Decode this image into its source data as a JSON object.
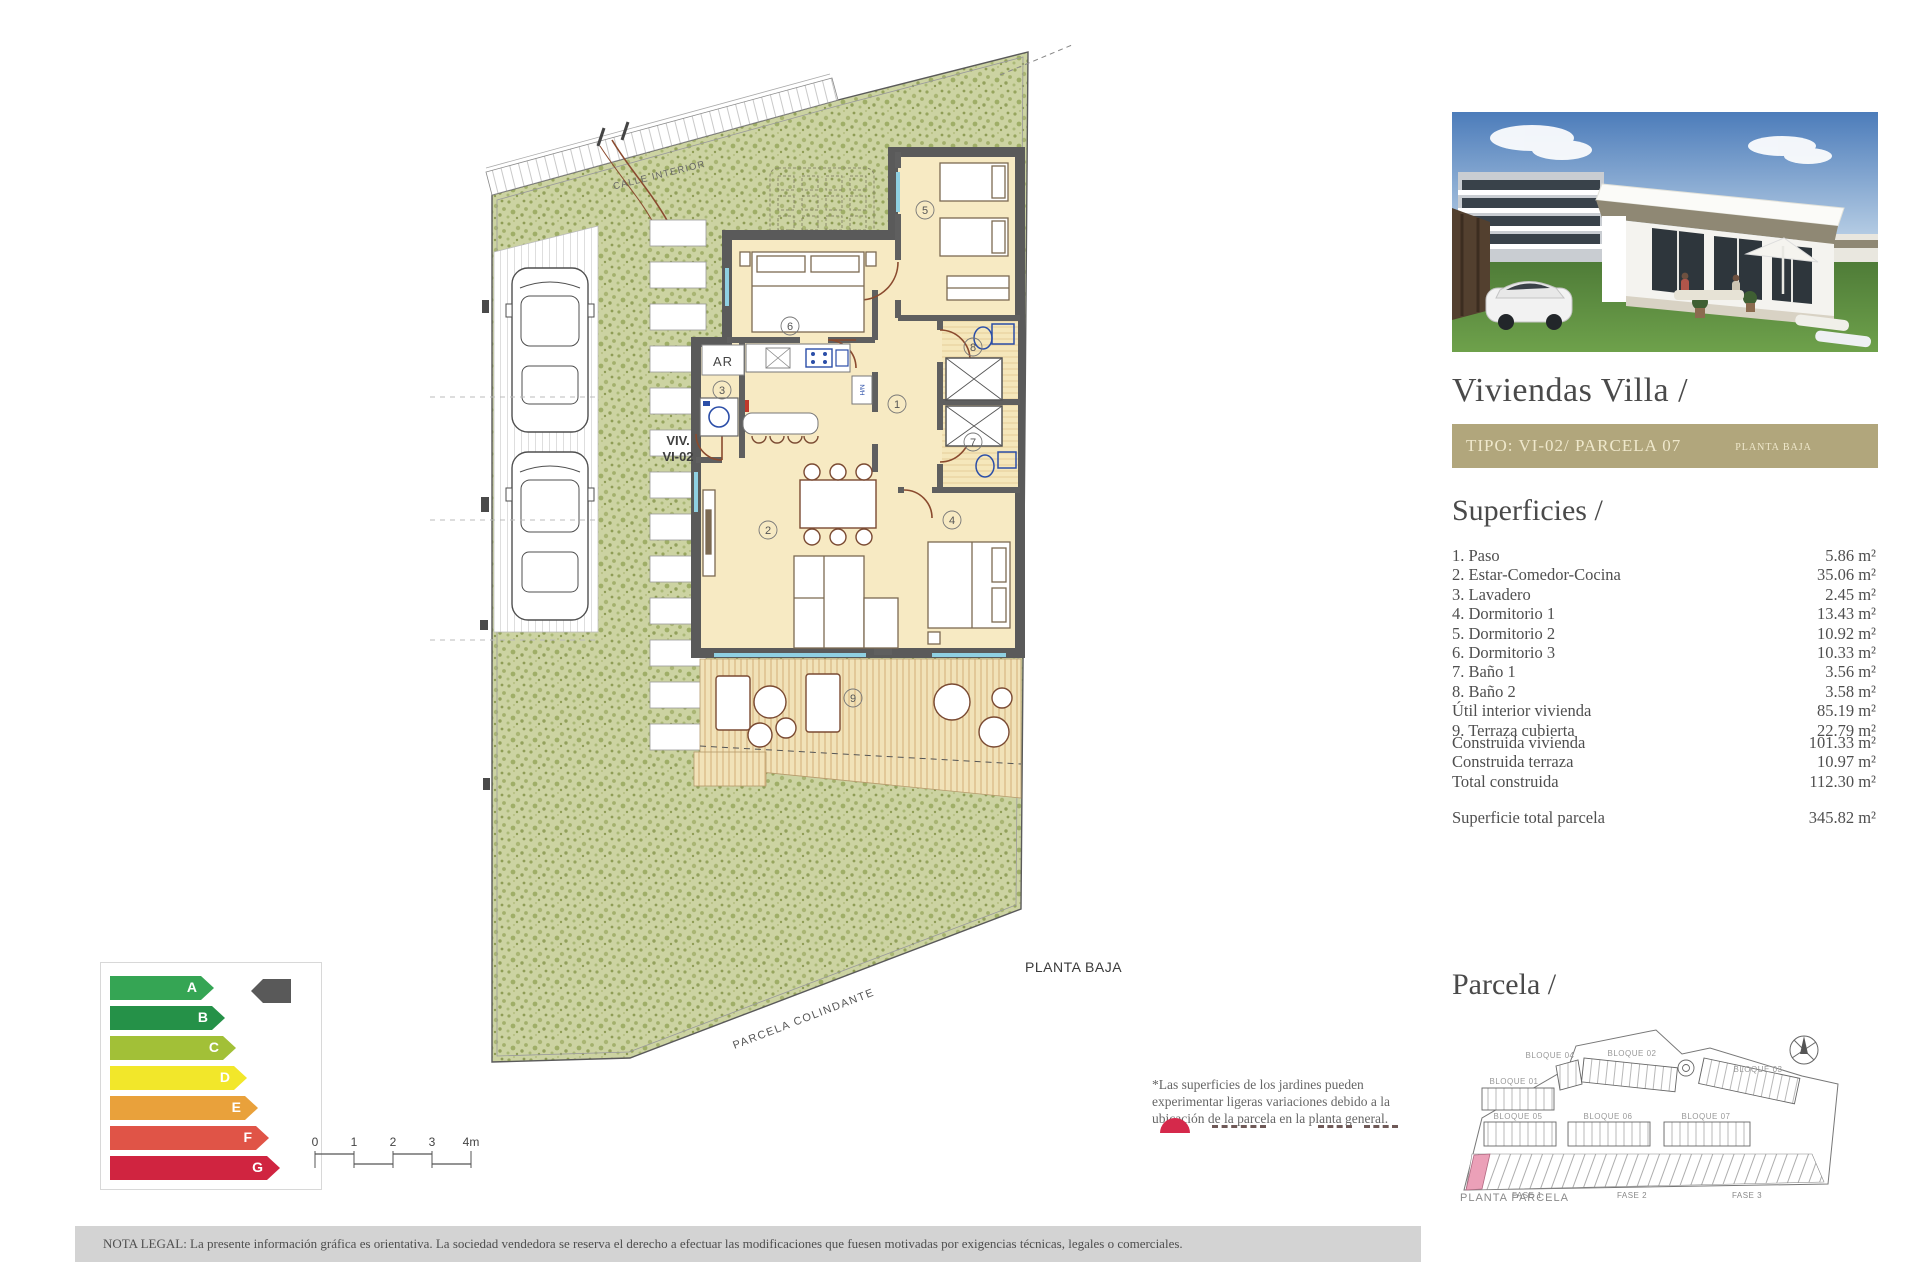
{
  "plan": {
    "street_label": "CALLE INTERIOR",
    "unit_label_line1": "VIV.",
    "unit_label_line2": "VI-02",
    "floor_label": "PLANTA BAJA",
    "neighbor_label": "PARCELA COLINDANTE",
    "ar_label": "AR",
    "fridge_label": "N/H",
    "rooms": [
      "1",
      "2",
      "3",
      "4",
      "5",
      "6",
      "7",
      "8",
      "9"
    ],
    "colors": {
      "grass": "#ccd3a2",
      "wall": "#5a5a5a",
      "room": "#f7eac3",
      "wood": "#f1e2b8",
      "window": "#8fd0e2",
      "door": "#8a4a2e"
    }
  },
  "energy": {
    "grades": [
      {
        "letter": "A",
        "color": "#35a554"
      },
      {
        "letter": "B",
        "color": "#259148"
      },
      {
        "letter": "C",
        "color": "#a2c037"
      },
      {
        "letter": "D",
        "color": "#f2e72a"
      },
      {
        "letter": "E",
        "color": "#e9a13b"
      },
      {
        "letter": "F",
        "color": "#e05447"
      },
      {
        "letter": "G",
        "color": "#d02440"
      }
    ],
    "selected": "A",
    "indicator_color": "#595959"
  },
  "scale_bar": {
    "ticks": [
      "0",
      "1",
      "2",
      "3",
      "4m"
    ]
  },
  "garden_note": {
    "text": "*Las superficies de los jardines pueden experimentar ligeras variaciones debido a la ubicación de la parcela en la planta general."
  },
  "legal": {
    "text": "NOTA LEGAL: La presente información gráfica es orientativa. La sociedad vendedora se reserva el derecho a efectuar las modificaciones que fuesen motivadas por exigencias técnicas, legales o comerciales."
  },
  "panel": {
    "title": "Viviendas Villa /",
    "type_bar": {
      "type": "TIPO: VI-02/ PARCELA 07",
      "floor": "PLANTA BAJA",
      "bg": "#b1a67c"
    },
    "superficies": {
      "title": "Superficies /",
      "rows": [
        {
          "label": "1. Paso",
          "value": "5.86 m²"
        },
        {
          "label": "2. Estar-Comedor-Cocina",
          "value": "35.06 m²"
        },
        {
          "label": "3. Lavadero",
          "value": "2.45 m²"
        },
        {
          "label": "4. Dormitorio 1",
          "value": "13.43 m²"
        },
        {
          "label": "5. Dormitorio 2",
          "value": "10.92 m²"
        },
        {
          "label": "6. Dormitorio 3",
          "value": "10.33 m²"
        },
        {
          "label": "7. Baño 1",
          "value": "3.56 m²"
        },
        {
          "label": "8. Baño 2",
          "value": "3.58 m²"
        },
        {
          "label": "Útil interior vivienda",
          "value": "85.19 m²"
        },
        {
          "label": "9. Terraza cubierta",
          "value": "22.79 m²"
        }
      ],
      "construida": [
        {
          "label": "Construida vivienda",
          "value": "101.33 m²"
        },
        {
          "label": "Construida terraza",
          "value": "10.97 m²"
        },
        {
          "label": "Total construida",
          "value": "112.30 m²"
        }
      ],
      "total": {
        "label": "Superficie total parcela",
        "value": "345.82 m²"
      }
    },
    "parcela": {
      "title": "Parcela /",
      "bloques": [
        "BLOQUE 04",
        "BLOQUE 02",
        "BLOQUE 01",
        "BLOQUE 03",
        "BLOQUE 05",
        "BLOQUE 06",
        "BLOQUE 07"
      ],
      "fases": [
        "FASE 1",
        "FASE 2",
        "FASE 3"
      ],
      "caption": "PLANTA PARCELA",
      "highlight_color": "#eba0b8"
    }
  }
}
